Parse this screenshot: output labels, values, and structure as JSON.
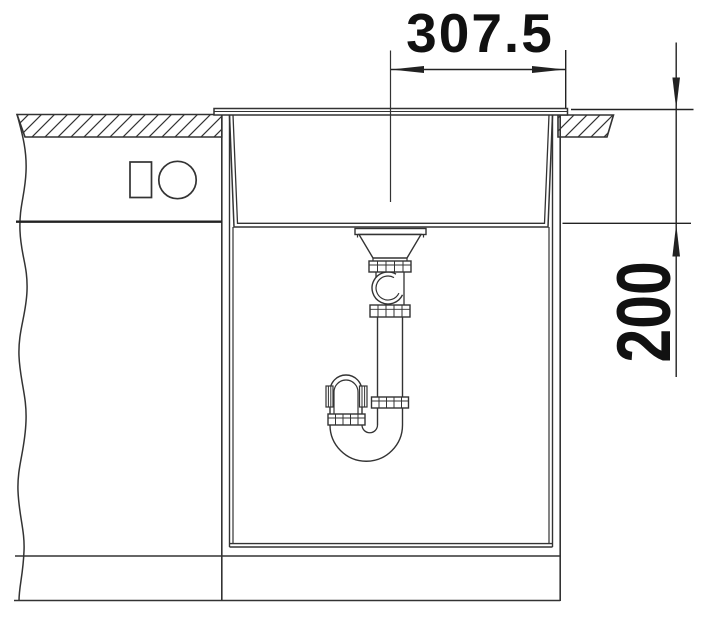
{
  "diagram": {
    "kind": "sink installation section drawing",
    "dimensions": {
      "width_label": "307.5",
      "depth_label": "200"
    },
    "colors": {
      "line": "#333333",
      "text": "#111111",
      "background": "#ffffff"
    }
  }
}
